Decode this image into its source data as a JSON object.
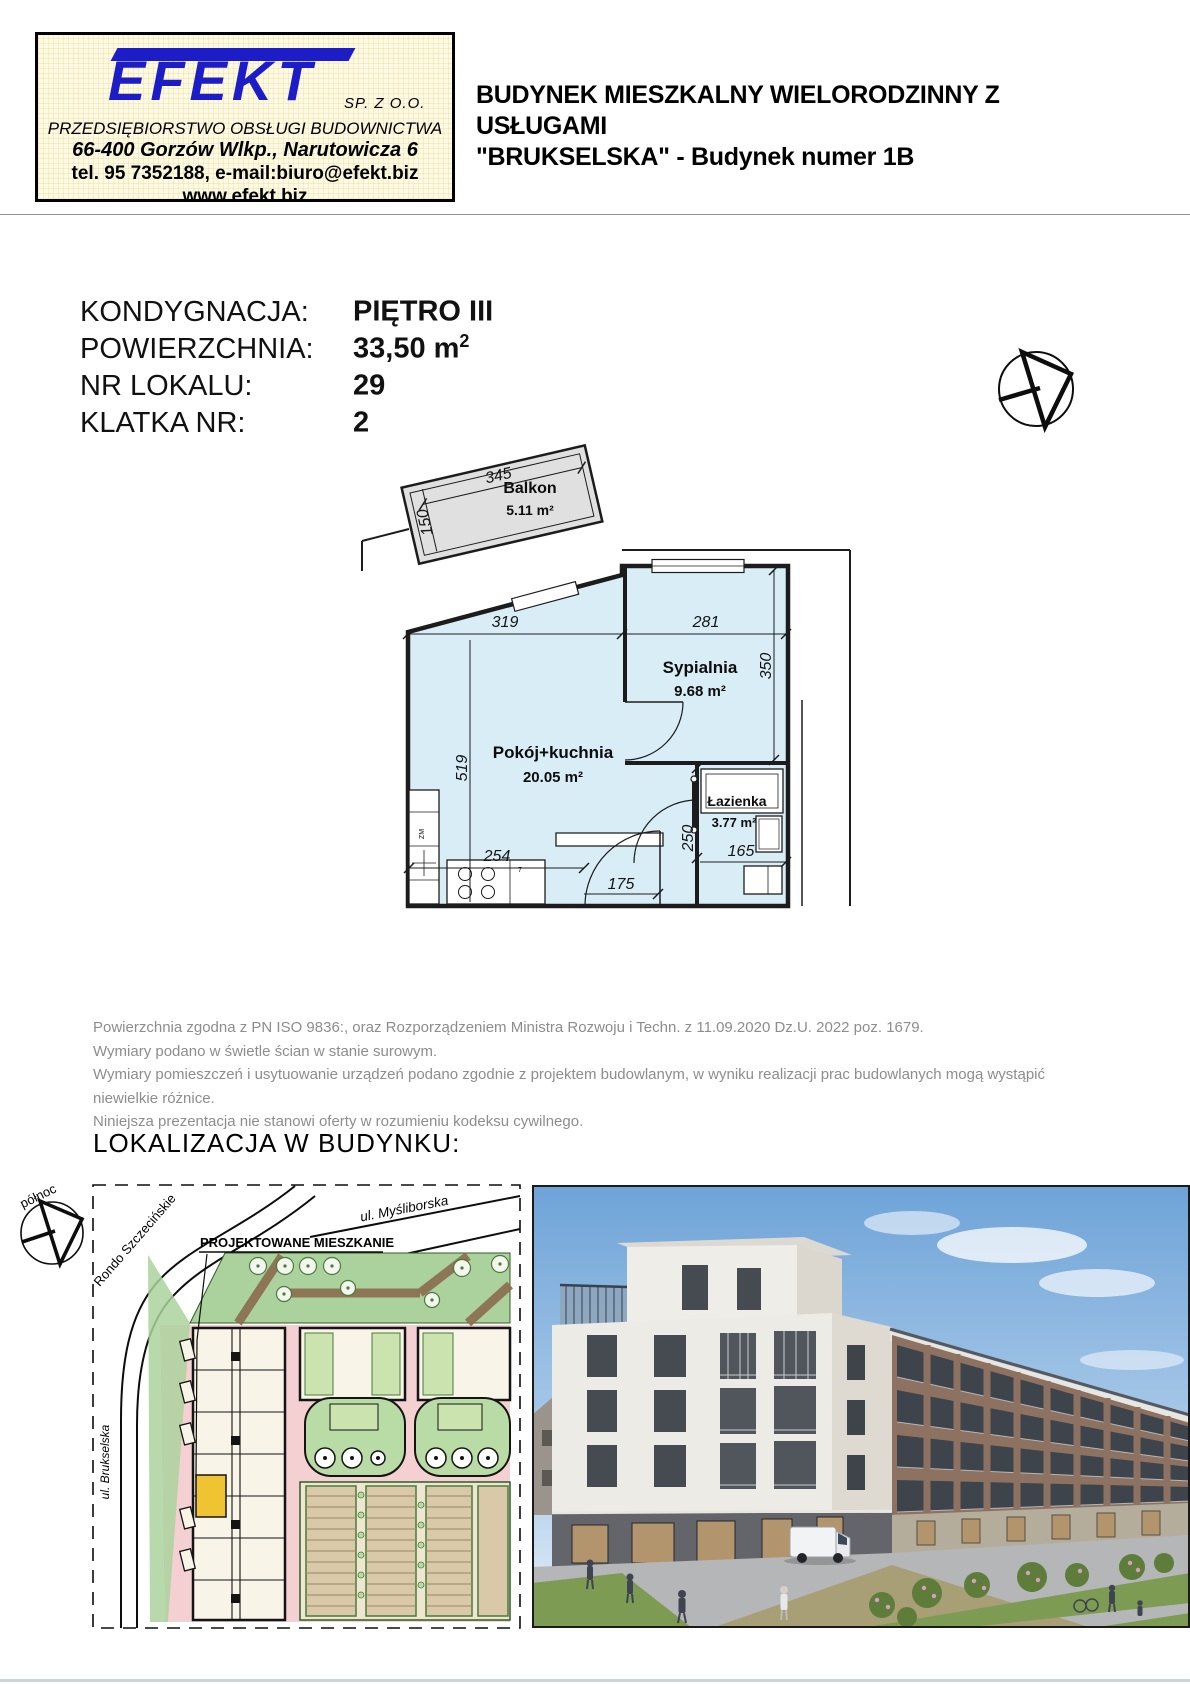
{
  "header": {
    "logo": {
      "brand": "EFEKT",
      "suffix": "SP. Z O.O.",
      "subtitle": "PRZEDSIĘBIORSTWO OBSŁUGI BUDOWNICTWA",
      "address": "66-400 Gorzów Wlkp., Narutowicza 6",
      "contact": "tel. 95 7352188, e-mail:biuro@efekt.biz",
      "website": "www.efekt.biz",
      "brand_color": "#1d1dc8"
    },
    "title_line1": "BUDYNEK MIESZKALNY WIELORODZINNY Z USŁUGAMI",
    "title_line2": "\"BRUKSELSKA\" - Budynek numer 1B"
  },
  "unit_info": {
    "rows": [
      {
        "label": "KONDYGNACJA:",
        "value": "PIĘTRO III",
        "value_sup": ""
      },
      {
        "label": "POWIERZCHNIA:",
        "value": "33,50 m",
        "value_sup": "2"
      },
      {
        "label": "NR LOKALU:",
        "value": "29",
        "value_sup": ""
      },
      {
        "label": "KLATKA NR:",
        "value": "2",
        "value_sup": ""
      }
    ]
  },
  "floor_plan": {
    "rooms": {
      "balkon": {
        "name": "Balkon",
        "area": "5.11 m²"
      },
      "sypialnia": {
        "name": "Sypialnia",
        "area": "9.68 m²"
      },
      "pokoj_kuchnia": {
        "name": "Pokój+kuchnia",
        "area": "20.05 m²"
      },
      "lazienka": {
        "name": "Łazienka",
        "area": "3.77 m²"
      }
    },
    "dims": {
      "balcony_width": "345",
      "balcony_depth": "150",
      "room_top_left": "319",
      "room_top_right": "281",
      "bedroom_height": "350",
      "room_height": "519",
      "kitchen_width": "254",
      "hall_width": "175",
      "bath_height": "250",
      "bath_width": "165"
    },
    "fixture_labels": {
      "zm": "ZM",
      "counter": "7"
    },
    "colors": {
      "room_fill": "#d9edf7",
      "balcony_fill": "#e0e0e0",
      "wall": "#1c1c1c"
    }
  },
  "notes": {
    "lines": [
      "Powierzchnia zgodna z PN ISO 9836:, oraz Rozporządzeniem Ministra Rozwoju i Techn. z 11.09.2020 Dz.U. 2022 poz. 1679.",
      "Wymiary podano w świetle ścian w stanie surowym.",
      "Wymiary pomieszczeń i usytuowanie urządzeń podano zgodnie z projektem budowlanym, w wyniku realizacji prac budowlanych mogą wystąpić niewielkie różnice.",
      "Niniejsza prezentacja nie stanowi oferty w rozumieniu kodeksu cywilnego."
    ]
  },
  "location": {
    "heading": "LOKALIZACJA W BUDYNKU:",
    "north_label": "północ",
    "streets": {
      "rondo": "Rondo Szczecińskie",
      "mysliborska": "ul. Myśliborska",
      "brukselska": "ul. Brukselska"
    },
    "callout": "PROJEKTOWANE MIESZKANIE",
    "highlight_color": "#f0c332"
  }
}
